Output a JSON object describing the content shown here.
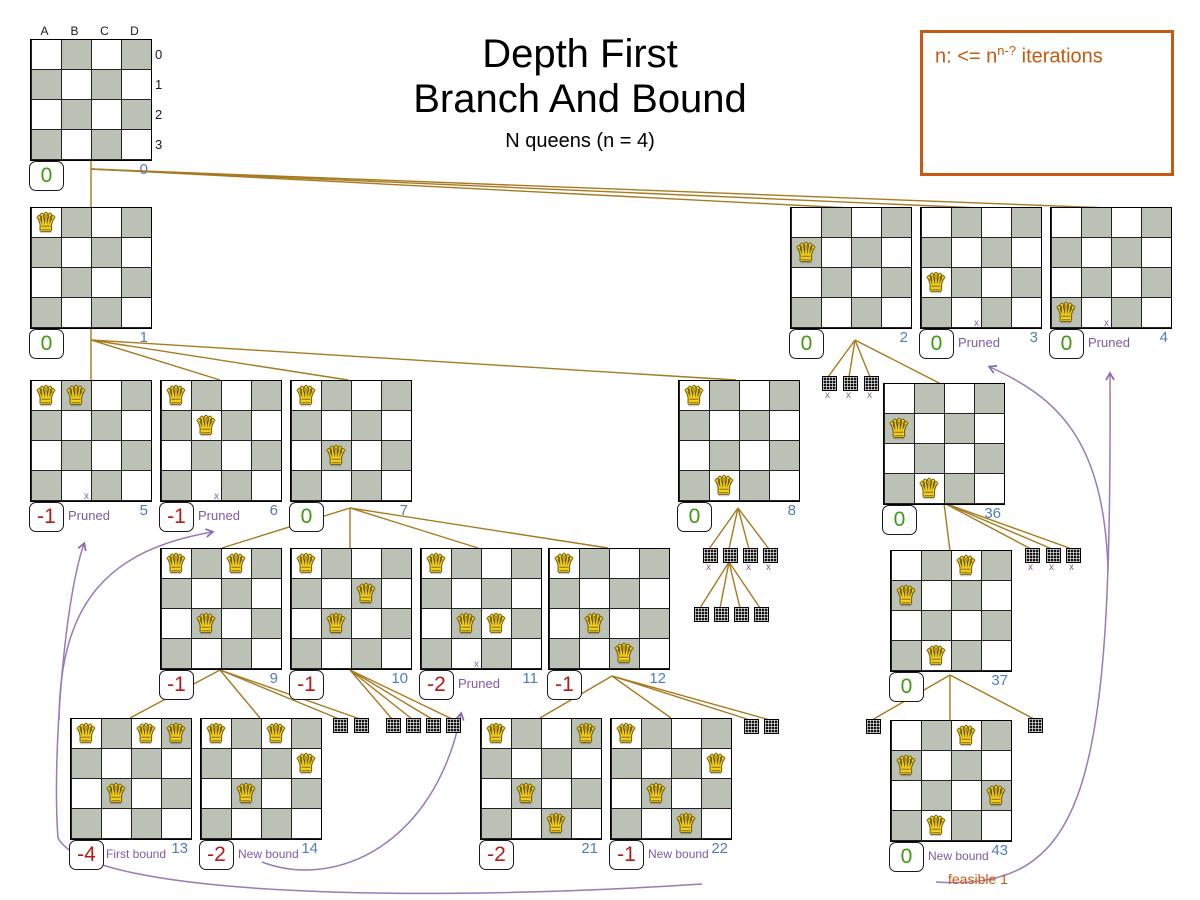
{
  "title": {
    "line1": "Depth First",
    "line2": "Branch And Bound",
    "subtitle": "N queens (n = 4)"
  },
  "note": {
    "prefix": "n: <= n",
    "sup": "n-?",
    "suffix": " iterations"
  },
  "axis": {
    "cols": [
      "A",
      "B",
      "C",
      "D"
    ],
    "rows": [
      "0",
      "1",
      "2",
      "3"
    ]
  },
  "labels": {
    "pruned": "Pruned",
    "first_bound": "First bound",
    "new_bound": "New bound",
    "feasible": "feasible 1",
    "xmark": "x"
  },
  "colors": {
    "edge": "#a87a20",
    "purple_text": "#7d5ba6",
    "purple_line": "#9a7ab8",
    "blue": "#4f7cbf",
    "green": "#3d9a12",
    "red": "#b01c1c",
    "orange": "#c55a11",
    "cell_gray": "#bcc1b6",
    "queen": "#f2cf1f"
  },
  "nodes": [
    {
      "id": "0",
      "x": 30,
      "y": 39,
      "score": "0",
      "tone": "green",
      "root": true,
      "queens": []
    },
    {
      "id": "1",
      "x": 30,
      "y": 207,
      "score": "0",
      "tone": "green",
      "queens": [
        [
          0,
          0
        ]
      ]
    },
    {
      "id": "2",
      "x": 790,
      "y": 207,
      "score": "0",
      "tone": "green",
      "queens": [
        [
          1,
          0
        ]
      ]
    },
    {
      "id": "3",
      "x": 920,
      "y": 207,
      "score": "0",
      "tone": "green",
      "queens": [
        [
          2,
          0
        ]
      ],
      "tag": "pruned"
    },
    {
      "id": "4",
      "x": 1050,
      "y": 207,
      "score": "0",
      "tone": "green",
      "queens": [
        [
          3,
          0
        ]
      ],
      "tag": "pruned"
    },
    {
      "id": "5",
      "x": 30,
      "y": 380,
      "score": "-1",
      "tone": "red",
      "queens": [
        [
          0,
          0
        ],
        [
          0,
          1
        ]
      ],
      "tag": "pruned"
    },
    {
      "id": "6",
      "x": 160,
      "y": 380,
      "score": "-1",
      "tone": "red",
      "queens": [
        [
          0,
          0
        ],
        [
          1,
          1
        ]
      ],
      "tag": "pruned"
    },
    {
      "id": "7",
      "x": 290,
      "y": 380,
      "score": "0",
      "tone": "green",
      "queens": [
        [
          0,
          0
        ],
        [
          2,
          1
        ]
      ]
    },
    {
      "id": "8",
      "x": 678,
      "y": 380,
      "score": "0",
      "tone": "green",
      "queens": [
        [
          0,
          0
        ],
        [
          3,
          1
        ]
      ]
    },
    {
      "id": "36",
      "x": 883,
      "y": 383,
      "score": "0",
      "tone": "green",
      "queens": [
        [
          1,
          0
        ],
        [
          3,
          1
        ]
      ]
    },
    {
      "id": "9",
      "x": 160,
      "y": 548,
      "score": "-1",
      "tone": "red",
      "queens": [
        [
          0,
          0
        ],
        [
          0,
          2
        ],
        [
          2,
          1
        ]
      ]
    },
    {
      "id": "10",
      "x": 290,
      "y": 548,
      "score": "-1",
      "tone": "red",
      "queens": [
        [
          0,
          0
        ],
        [
          1,
          2
        ],
        [
          2,
          1
        ]
      ]
    },
    {
      "id": "11",
      "x": 420,
      "y": 548,
      "score": "-2",
      "tone": "red",
      "queens": [
        [
          0,
          0
        ],
        [
          2,
          1
        ],
        [
          2,
          2
        ]
      ],
      "tag": "pruned"
    },
    {
      "id": "12",
      "x": 548,
      "y": 548,
      "score": "-1",
      "tone": "red",
      "queens": [
        [
          0,
          0
        ],
        [
          2,
          1
        ],
        [
          3,
          2
        ]
      ]
    },
    {
      "id": "37",
      "x": 890,
      "y": 550,
      "score": "0",
      "tone": "green",
      "queens": [
        [
          0,
          2
        ],
        [
          1,
          0
        ],
        [
          3,
          1
        ]
      ]
    },
    {
      "id": "13",
      "x": 70,
      "y": 718,
      "score": "-4",
      "tone": "red",
      "queens": [
        [
          0,
          0
        ],
        [
          0,
          2
        ],
        [
          0,
          3
        ],
        [
          2,
          1
        ]
      ],
      "tag": "first_bound"
    },
    {
      "id": "14",
      "x": 200,
      "y": 718,
      "score": "-2",
      "tone": "red",
      "queens": [
        [
          0,
          0
        ],
        [
          0,
          2
        ],
        [
          1,
          3
        ],
        [
          2,
          1
        ]
      ],
      "tag": "new_bound"
    },
    {
      "id": "21",
      "x": 480,
      "y": 718,
      "score": "-2",
      "tone": "red",
      "queens": [
        [
          0,
          0
        ],
        [
          0,
          3
        ],
        [
          2,
          1
        ],
        [
          3,
          2
        ]
      ]
    },
    {
      "id": "22",
      "x": 610,
      "y": 718,
      "score": "-1",
      "tone": "red",
      "queens": [
        [
          0,
          0
        ],
        [
          1,
          3
        ],
        [
          2,
          1
        ],
        [
          3,
          2
        ]
      ],
      "tag": "new_bound"
    },
    {
      "id": "43",
      "x": 890,
      "y": 720,
      "score": "0",
      "tone": "green",
      "queens": [
        [
          0,
          2
        ],
        [
          1,
          0
        ],
        [
          2,
          3
        ],
        [
          3,
          1
        ]
      ],
      "tag": "new_bound",
      "extra": "feasible"
    }
  ],
  "mini_boards": [
    {
      "x": 822,
      "y": 376,
      "xmark": true
    },
    {
      "x": 843,
      "y": 376,
      "xmark": true
    },
    {
      "x": 864,
      "y": 376,
      "xmark": true
    },
    {
      "x": 703,
      "y": 548,
      "xmark": true
    },
    {
      "x": 723,
      "y": 548,
      "xmark": false
    },
    {
      "x": 743,
      "y": 548,
      "xmark": true
    },
    {
      "x": 763,
      "y": 548,
      "xmark": true
    },
    {
      "x": 694,
      "y": 607,
      "xmark": false
    },
    {
      "x": 714,
      "y": 607,
      "xmark": false
    },
    {
      "x": 734,
      "y": 607,
      "xmark": false
    },
    {
      "x": 754,
      "y": 607,
      "xmark": false
    },
    {
      "x": 1025,
      "y": 548,
      "xmark": true
    },
    {
      "x": 1046,
      "y": 548,
      "xmark": true
    },
    {
      "x": 1066,
      "y": 548,
      "xmark": true
    },
    {
      "x": 333,
      "y": 718,
      "xmark": false
    },
    {
      "x": 354,
      "y": 718,
      "xmark": false
    },
    {
      "x": 386,
      "y": 718,
      "xmark": false
    },
    {
      "x": 406,
      "y": 718,
      "xmark": false
    },
    {
      "x": 426,
      "y": 718,
      "xmark": false
    },
    {
      "x": 446,
      "y": 718,
      "xmark": false
    },
    {
      "x": 744,
      "y": 719,
      "xmark": false
    },
    {
      "x": 764,
      "y": 719,
      "xmark": false
    },
    {
      "x": 866,
      "y": 719,
      "xmark": false
    },
    {
      "x": 1028,
      "y": 718,
      "xmark": false
    }
  ],
  "edges": [
    [
      91,
      158,
      91,
      380
    ],
    [
      91,
      169,
      850,
      208
    ],
    [
      91,
      169,
      980,
      208
    ],
    [
      91,
      169,
      1110,
      208
    ],
    [
      91,
      340,
      220,
      380
    ],
    [
      91,
      340,
      348,
      380
    ],
    [
      91,
      340,
      736,
      380
    ],
    [
      855,
      340,
      828,
      377
    ],
    [
      855,
      340,
      849,
      377
    ],
    [
      855,
      340,
      870,
      377
    ],
    [
      855,
      340,
      941,
      384
    ],
    [
      350,
      508,
      222,
      548
    ],
    [
      350,
      508,
      350,
      548
    ],
    [
      350,
      508,
      478,
      548
    ],
    [
      350,
      508,
      608,
      548
    ],
    [
      738,
      508,
      709,
      549
    ],
    [
      738,
      508,
      729,
      549
    ],
    [
      738,
      508,
      749,
      549
    ],
    [
      738,
      508,
      769,
      549
    ],
    [
      729,
      562,
      700,
      608
    ],
    [
      729,
      562,
      720,
      608
    ],
    [
      729,
      562,
      740,
      608
    ],
    [
      729,
      562,
      760,
      608
    ],
    [
      944,
      503,
      950,
      551
    ],
    [
      944,
      503,
      1031,
      549
    ],
    [
      944,
      503,
      1052,
      549
    ],
    [
      944,
      503,
      1072,
      549
    ],
    [
      220,
      670,
      130,
      718
    ],
    [
      220,
      670,
      260,
      718
    ],
    [
      220,
      670,
      339,
      719
    ],
    [
      220,
      670,
      360,
      719
    ],
    [
      350,
      670,
      392,
      719
    ],
    [
      350,
      670,
      412,
      719
    ],
    [
      350,
      670,
      432,
      719
    ],
    [
      350,
      670,
      452,
      719
    ],
    [
      612,
      676,
      540,
      718
    ],
    [
      612,
      676,
      671,
      718
    ],
    [
      612,
      676,
      750,
      720
    ],
    [
      612,
      676,
      770,
      720
    ],
    [
      950,
      675,
      872,
      720
    ],
    [
      950,
      675,
      950,
      720
    ],
    [
      950,
      675,
      1034,
      719
    ]
  ],
  "prune_curves": [
    {
      "name": "newbound22-to-pruned5",
      "path": "M 702 884 C 430 902, 90 898, 58 838 C 52 760, 64 600, 84 544"
    },
    {
      "name": "newbound22-to-pruned6",
      "path": "M 59 720 C 60 600, 110 550, 212 532"
    },
    {
      "name": "newbound14-to-pruned11",
      "path": "M 262 862 C 335 890, 435 845, 461 714"
    },
    {
      "name": "newbound43-to-pruned4",
      "path": "M 936 882 C 1090 892, 1112 780, 1110 374"
    },
    {
      "name": "newbound43-to-pruned3",
      "path": "M 1108 570 C 1104 440, 1058 398, 990 367"
    }
  ]
}
